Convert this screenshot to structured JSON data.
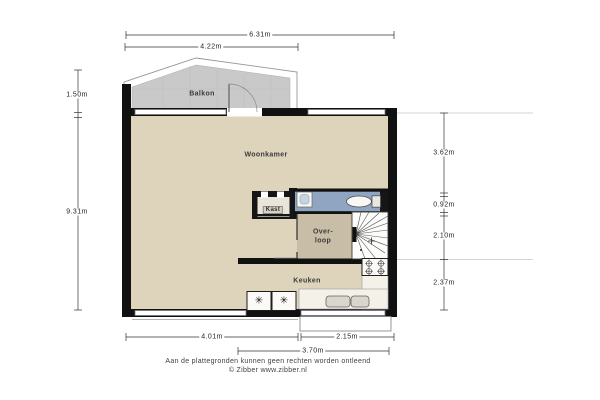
{
  "rooms": {
    "balkon": "Balkon",
    "woonkamer": "Woonkamer",
    "kast": "Kast",
    "overloop_line1": "Over-",
    "overloop_line2": "loop",
    "keuken": "Keuken"
  },
  "dimensions": {
    "top_total": "6.31m",
    "top_balcony": "4.22m",
    "left_balcony_depth": "1.50m",
    "left_total": "9.31m",
    "right_top": "3.62m",
    "right_upper_mid": "0.92m",
    "right_lower_mid": "2.10m",
    "right_bottom": "2.37m",
    "bottom_left": "4.01m",
    "bottom_right": "2.15m",
    "bottom_inner": "3.70m"
  },
  "icons": {
    "appliance_symbol": "✳"
  },
  "footer": {
    "disclaimer": "Aan de plattegronden kunnen geen rechten worden ontleend",
    "copyright": "© Zibber www.zibber.nl"
  },
  "colors": {
    "floor_main": "#ded4bc",
    "floor_overloop": "#c8bda7",
    "floor_toilet": "#90a5c1",
    "floor_balcony": "#c9c9c9",
    "wall": "#111111",
    "counter": "#f4f1e9"
  }
}
